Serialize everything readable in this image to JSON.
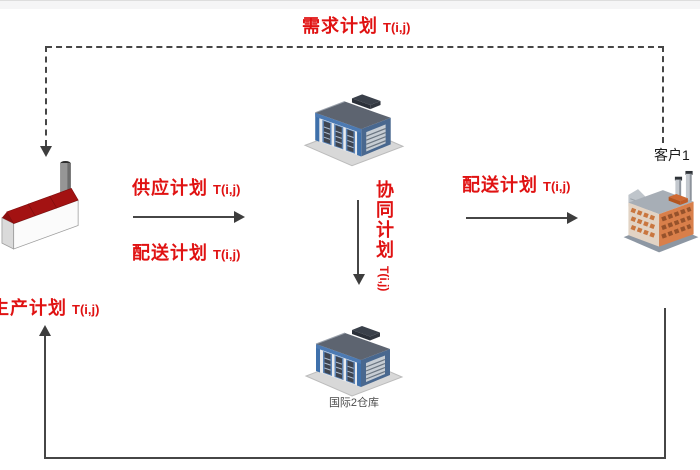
{
  "diagram": {
    "flows": {
      "demand": {
        "label": "需求计划",
        "param": "T(i,j)"
      },
      "supply": {
        "label": "供应计划",
        "param": "T(i,j)"
      },
      "delivery_left": {
        "label": "配送计划",
        "param": "T(i,j)"
      },
      "delivery_right": {
        "label": "配送计划",
        "param": "T(i,j)"
      },
      "collaboration": {
        "label": "协同计划",
        "param": "T(i,j)"
      },
      "production": {
        "label": "生产计划",
        "param": "T(i,j)"
      }
    },
    "nodes": {
      "customer": {
        "label": "客户1"
      },
      "warehouse_bottom": {
        "label": "国际2仓库"
      }
    },
    "colors": {
      "flow_text": "#e01212",
      "line": "#464646",
      "node_text": "#1a1a1a",
      "caption_text": "#4a4a4a"
    }
  }
}
